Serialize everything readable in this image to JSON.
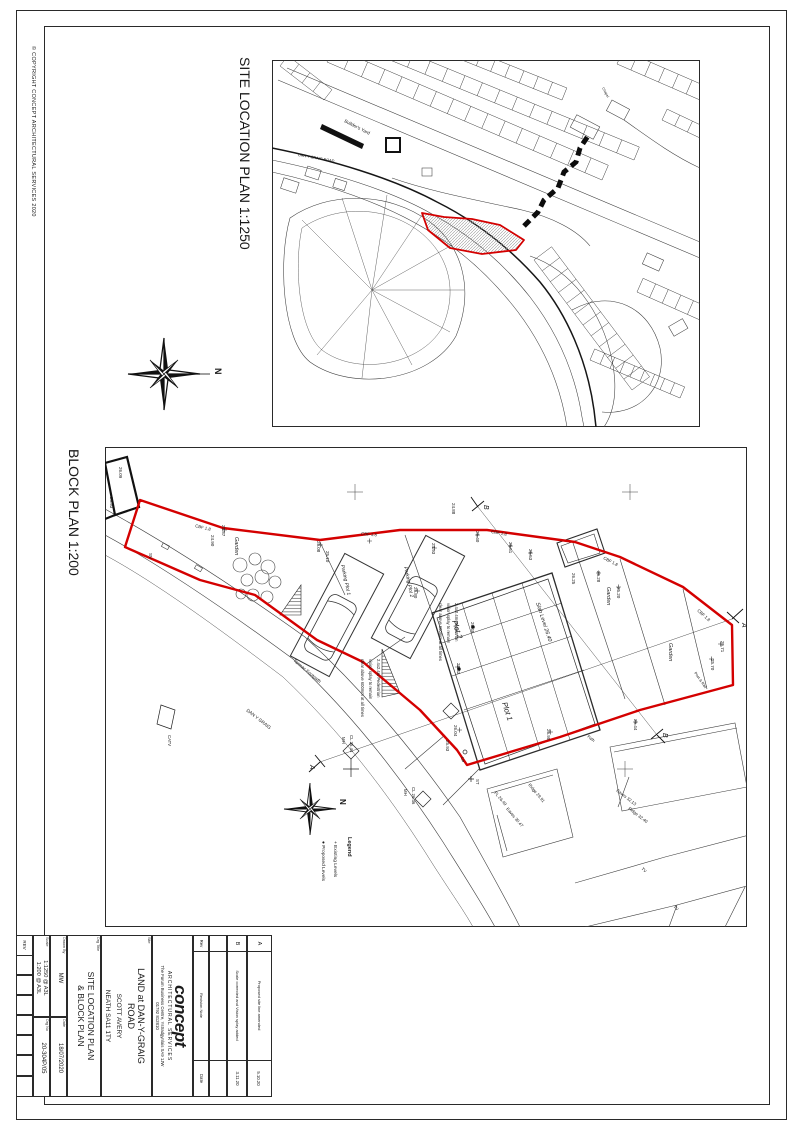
{
  "page": {
    "copyright": "© COPYRIGHT CONCEPT ARCHITECTURAL SERVICES 2020",
    "site_plan_title": "SITE LOCATION PLAN 1:1250",
    "block_plan_title": "BLOCK PLAN 1:200"
  },
  "compass": {
    "labels": [
      {
        "t": "N",
        "x": 97,
        "y": 40,
        "r": 90,
        "s": 9,
        "b": true
      }
    ]
  },
  "site_plan": {
    "labels": [
      {
        "t": "Builder's Yard",
        "x": 72,
        "y": 62,
        "r": 27,
        "s": 4.6
      },
      {
        "t": "DAN Y GRAIG ROAD",
        "x": 26,
        "y": 96,
        "r": 10,
        "s": 3.8
      },
      {
        "t": "Chapel",
        "x": 330,
        "y": 28,
        "r": 62,
        "s": 3.5
      }
    ]
  },
  "block_plan": {
    "labels": [
      {
        "t": "26.09",
        "x": 14,
        "y": 20,
        "s": 4.5
      },
      {
        "t": "25.93",
        "x": 5,
        "y": 50,
        "s": 4.5
      },
      {
        "t": "SV",
        "x": 44,
        "y": 106,
        "s": 4.5
      },
      {
        "t": "CBF 1.8",
        "x": 90,
        "y": 80,
        "r": 14,
        "s": 4.3
      },
      {
        "t": "24.87",
        "x": 117,
        "y": 78,
        "s": 4.5
      },
      {
        "t": "24.90",
        "x": 106,
        "y": 88,
        "s": 4.5
      },
      {
        "t": "Garden",
        "x": 130,
        "y": 90,
        "s": 5.5,
        "i": true
      },
      {
        "t": "25.08",
        "x": 212,
        "y": 94,
        "s": 4.5
      },
      {
        "t": "25.10",
        "x": 221,
        "y": 104,
        "s": 4.5
      },
      {
        "t": "CBF 1.8",
        "x": 256,
        "y": 88,
        "r": 5,
        "s": 4.3
      },
      {
        "t": "24.93",
        "x": 327,
        "y": 96,
        "s": 4.5
      },
      {
        "t": "25.80",
        "x": 309,
        "y": 140,
        "s": 4.5
      },
      {
        "t": "24.88",
        "x": 347,
        "y": 56,
        "s": 4.5
      },
      {
        "t": "25.40",
        "x": 371,
        "y": 84,
        "s": 4.5
      },
      {
        "t": "CBF 1.8",
        "x": 386,
        "y": 86,
        "r": 10,
        "s": 4.3
      },
      {
        "t": "25.51",
        "x": 404,
        "y": 95,
        "s": 4.5
      },
      {
        "t": "25.53",
        "x": 424,
        "y": 102,
        "s": 4.5
      },
      {
        "t": "CBF 1.8",
        "x": 498,
        "y": 112,
        "r": 28,
        "s": 4.3
      },
      {
        "t": "25.28",
        "x": 492,
        "y": 124,
        "s": 4.5
      },
      {
        "t": "25.20",
        "x": 512,
        "y": 140,
        "s": 4.5
      },
      {
        "t": "Garden",
        "x": 502,
        "y": 140,
        "s": 5.5,
        "i": true
      },
      {
        "t": "CBF 1.8",
        "x": 592,
        "y": 164,
        "r": 42,
        "s": 4.3
      },
      {
        "t": "25.71",
        "x": 616,
        "y": 194,
        "s": 4.5
      },
      {
        "t": "25.70",
        "x": 606,
        "y": 212,
        "s": 4.5
      },
      {
        "t": "Garden",
        "x": 564,
        "y": 196,
        "s": 5.5,
        "i": true
      },
      {
        "t": "Post & Rail",
        "x": 589,
        "y": 226,
        "r": 55,
        "s": 3.8
      },
      {
        "t": "Parking Plot 1",
        "x": 236,
        "y": 118,
        "r": 78,
        "s": 5,
        "i": true
      },
      {
        "t": "Parking Plot 2",
        "x": 299,
        "y": 120,
        "r": 78,
        "s": 5,
        "i": true
      },
      {
        "t": "Plot 2",
        "x": 347,
        "y": 174,
        "r": 72,
        "s": 7.5,
        "i": true
      },
      {
        "t": "Plot 1",
        "x": 397,
        "y": 256,
        "r": 72,
        "s": 7.5,
        "i": true
      },
      {
        "t": "Slab Level 26.40",
        "x": 431,
        "y": 156,
        "r": 72,
        "s": 5.5,
        "i": true
      },
      {
        "t": "26.45",
        "x": 366,
        "y": 175,
        "s": 4.5
      },
      {
        "t": "26.25",
        "x": 467,
        "y": 126,
        "s": 4.5
      },
      {
        "t": "26.43",
        "x": 352,
        "y": 216,
        "s": 4.5
      },
      {
        "t": "26.04",
        "x": 349,
        "y": 278,
        "s": 4.5
      },
      {
        "t": "25.93",
        "x": 341,
        "y": 293,
        "s": 4.5
      },
      {
        "t": "25.95",
        "x": 442,
        "y": 282,
        "s": 4.5
      },
      {
        "t": "25.44",
        "x": 529,
        "y": 272,
        "s": 4.5
      },
      {
        "t": "Path",
        "x": 482,
        "y": 290,
        "r": 38,
        "s": 4
      },
      {
        "t": "LP",
        "x": 356,
        "y": 310,
        "s": 4.3
      },
      {
        "t": "ST",
        "x": 371,
        "y": 332,
        "s": 4.3
      },
      {
        "t": "MH",
        "x": 237,
        "y": 290,
        "s": 4.3
      },
      {
        "t": "CL 25.44",
        "x": 245,
        "y": 288,
        "s": 4.3
      },
      {
        "t": "MH",
        "x": 299,
        "y": 342,
        "s": 4.3
      },
      {
        "t": "CL 26.36",
        "x": 307,
        "y": 340,
        "s": 4.3
      },
      {
        "t": "CATV",
        "x": 63,
        "y": 288,
        "s": 4.3
      },
      {
        "t": "Tarmac Footpath",
        "x": 188,
        "y": 214,
        "r": 40,
        "s": 4.6
      },
      {
        "t": "DAN Y GRAIG",
        "x": 141,
        "y": 264,
        "r": 38,
        "s": 4.6
      },
      {
        "t": "FL 26.49",
        "x": 389,
        "y": 346,
        "r": 50,
        "s": 4.3
      },
      {
        "t": "Ridge 29.91",
        "x": 423,
        "y": 338,
        "r": 50,
        "s": 4.3
      },
      {
        "t": "Eaves 30.47",
        "x": 401,
        "y": 362,
        "r": 50,
        "s": 4.3
      },
      {
        "t": "Eaves 32.13",
        "x": 511,
        "y": 344,
        "r": 38,
        "s": 4.3
      },
      {
        "t": "Ridge 32.40",
        "x": 523,
        "y": 362,
        "r": 38,
        "s": 4.3
      },
      {
        "t": "TV",
        "x": 536,
        "y": 422,
        "r": 45,
        "s": 4.3
      },
      {
        "t": "TV",
        "x": 568,
        "y": 460,
        "r": 45,
        "s": 4.3
      },
      {
        "t": "A",
        "x": 637,
        "y": 176,
        "s": 7,
        "i": true
      },
      {
        "t": "A",
        "x": 205,
        "y": 318,
        "s": 7,
        "i": true
      },
      {
        "t": "B",
        "x": 379,
        "y": 58,
        "s": 7,
        "i": true
      },
      {
        "t": "B",
        "x": 558,
        "y": 286,
        "s": 7,
        "i": true
      },
      {
        "t": "N",
        "x": 235,
        "y": 352,
        "s": 8,
        "b": true
      },
      {
        "t": "Legend",
        "x": 243,
        "y": 390,
        "s": 5.5,
        "b": true
      },
      {
        "t": "+ Existing Levels",
        "x": 229,
        "y": 394,
        "s": 4.8
      },
      {
        "t": "● Proposed Levels",
        "x": 217,
        "y": 394,
        "s": 4.8
      },
      {
        "t": "2.4x2.4m Pedestrian",
        "x": 272,
        "y": 212,
        "s": 4.2
      },
      {
        "t": "vision splay to remain",
        "x": 264,
        "y": 212,
        "s": 4.2
      },
      {
        "t": "clear above 600mm at all times",
        "x": 256,
        "y": 212,
        "s": 4.2
      },
      {
        "t": "2.4x2.4m Pedestrian",
        "x": 350,
        "y": 156,
        "s": 4.2
      },
      {
        "t": "vision splay to remain",
        "x": 342,
        "y": 156,
        "s": 4.2
      },
      {
        "t": "clear above 600mm at all times",
        "x": 334,
        "y": 156,
        "s": 4.2
      }
    ]
  },
  "title_block": {
    "rev_header": "REV",
    "scale_label": "Scale",
    "scale_line1": "1:1250 @ A3L",
    "scale_line2": "1:200 @ A3L",
    "drawn_label": "Drawn By",
    "drawn_value": "MW",
    "drgno_label": "Drg No",
    "drgno_value": "20-304P/05",
    "date_label": "Date",
    "date_value": "18/07/2020",
    "title_label": "Drg Title",
    "title_line1": "SITE LOCATION PLAN",
    "title_line2": "& BLOCK PLAN",
    "site_label": "Site",
    "site_line1": "LAND at DAN-Y-GRAIG",
    "site_line2": "ROAD",
    "site_client": "SCOTT AVERY",
    "site_town": "NEATH SA11 1TY",
    "logo": "concept",
    "logo_sub": "ARCHITECTURAL SERVICES",
    "logo_addr": "The Forum Business Centre, Ystradgynlais SA9 1JW",
    "logo_phone": "01792 812810",
    "revisions": {
      "col_rev": "Rev",
      "col_note": "Revision Note",
      "col_date": "Date",
      "rows": [
        {
          "rev": "A",
          "note": "Proposed site line amended",
          "date": "5.10.20"
        },
        {
          "rev": "B",
          "note": "Scale corrected and Vision splay added",
          "date": "3.11.20"
        }
      ]
    }
  }
}
